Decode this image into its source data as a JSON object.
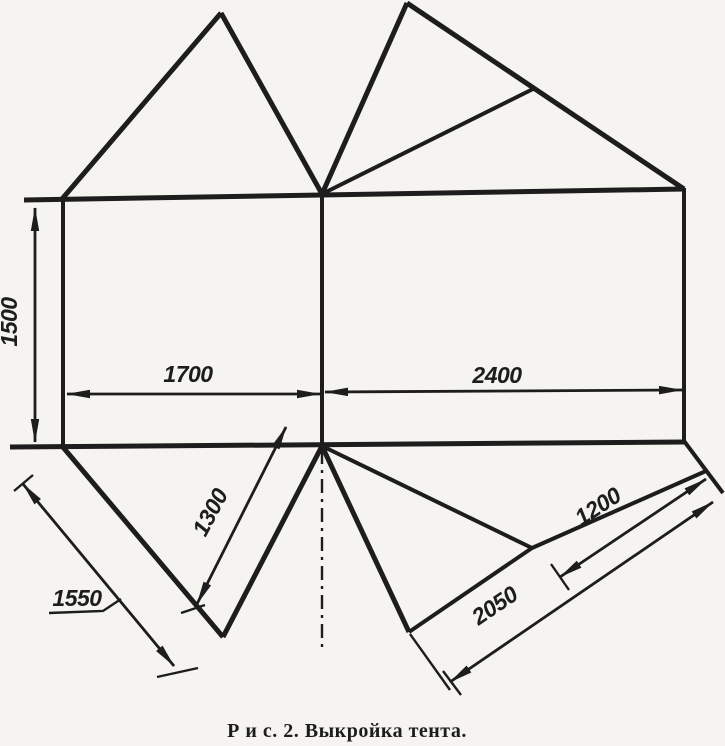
{
  "figure": {
    "caption": "Р и с. 2.  Выкройка тента.",
    "dimensions": {
      "height_left": "1500",
      "width_left": "1700",
      "width_right": "2400",
      "flap_left_outer": "1550",
      "flap_left_inner": "1300",
      "flap_right_inner": "1200",
      "flap_right_outer": "2050"
    },
    "colors": {
      "ink": "#1d1d1d",
      "paper": "#f5f4f1"
    }
  }
}
